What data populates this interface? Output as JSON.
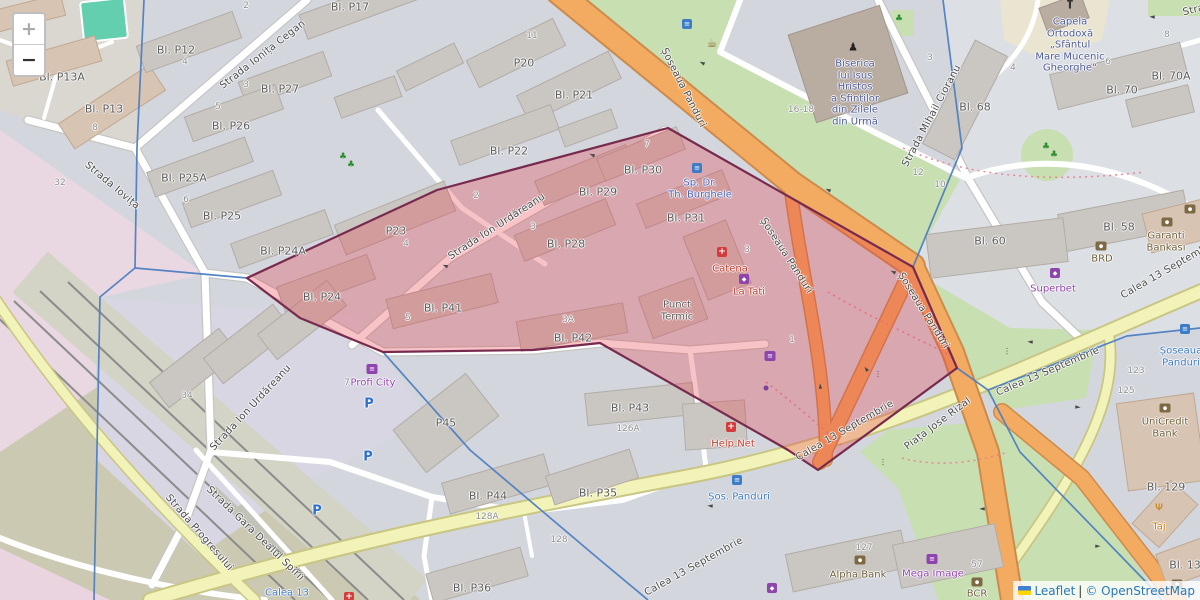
{
  "colors": {
    "hl_fill": "rgba(229,57,70,0.30)",
    "hl_stroke": "#772a4e",
    "boundary": "#4e7ec1",
    "link": "#2a77b8"
  },
  "controls": {
    "zoom_in": "+",
    "zoom_out": "−"
  },
  "attribution": {
    "leaflet": "Leaflet",
    "separator": "|",
    "osm": "© OpenStreetMap"
  },
  "icon_glyphs": {
    "bus": "≡",
    "cafe": "☕",
    "pharmacy": "+",
    "bank": "●",
    "cart": "≡",
    "shop": "◆",
    "betting": "◆",
    "restaurant": "Ψ",
    "church": "†",
    "statue": "♟",
    "parking": "P",
    "tree": "♣",
    "signal": "⋮",
    "arrow": "►",
    "dot-purple": ""
  },
  "map": {
    "street_labels": [
      {
        "t": "Strada Ionița Cegan",
        "x": 263,
        "y": 55,
        "r": -38
      },
      {
        "t": "Strada Iovița",
        "x": 112,
        "y": 186,
        "r": 40
      },
      {
        "t": "Strada Ion Urdăreanu",
        "x": 497,
        "y": 227,
        "r": -33
      },
      {
        "t": "Strada Ion Urdăreanu",
        "x": 251,
        "y": 408,
        "r": -47
      },
      {
        "t": "Șoseaua Panduri",
        "x": 683,
        "y": 88,
        "r": 63
      },
      {
        "t": "Șoseaua Panduri",
        "x": 786,
        "y": 256,
        "r": 57
      },
      {
        "t": "Șoseaua Panduri",
        "x": 923,
        "y": 311,
        "r": 58
      },
      {
        "t": "Calea 13 Septembrie",
        "x": 845,
        "y": 431,
        "r": -30
      },
      {
        "t": "Piața Jose Rizal",
        "x": 938,
        "y": 424,
        "r": -37
      },
      {
        "t": "Calea 13 Septembrie",
        "x": 1048,
        "y": 372,
        "r": -23
      },
      {
        "t": "Calea 13 Septembrie",
        "x": 1170,
        "y": 269,
        "r": -30
      },
      {
        "t": "Calea 13 Septembrie",
        "x": 694,
        "y": 567,
        "r": -29
      },
      {
        "t": "Strada Progresului",
        "x": 199,
        "y": 533,
        "r": 49
      },
      {
        "t": "Strada Gara Dealul Spirii",
        "x": 255,
        "y": 534,
        "r": 44
      },
      {
        "t": "Strada Mihail Cioranu",
        "x": 932,
        "y": 116,
        "r": -62
      },
      {
        "t": "Strada",
        "x": 1200,
        "y": 9,
        "r": -14
      }
    ],
    "building_labels": [
      {
        "t": "Bl. P13A",
        "x": 62,
        "y": 78
      },
      {
        "t": "Bl. P13",
        "x": 104,
        "y": 110
      },
      {
        "t": "Bl. P12",
        "x": 176,
        "y": 51
      },
      {
        "t": "Bl. P27",
        "x": 280,
        "y": 90
      },
      {
        "t": "Bl. P26",
        "x": 231,
        "y": 127
      },
      {
        "t": "Bl. P17",
        "x": 350,
        "y": 8
      },
      {
        "t": "P20",
        "x": 524,
        "y": 64
      },
      {
        "t": "Bl. P21",
        "x": 574,
        "y": 96
      },
      {
        "t": "Bl. P25A",
        "x": 184,
        "y": 179
      },
      {
        "t": "Bl. P25",
        "x": 222,
        "y": 217
      },
      {
        "t": "Bl. P24A",
        "x": 283,
        "y": 252
      },
      {
        "t": "Bl. P24",
        "x": 322,
        "y": 298
      },
      {
        "t": "Bl. P22",
        "x": 509,
        "y": 152
      },
      {
        "t": "P23",
        "x": 396,
        "y": 232
      },
      {
        "t": "Bl. P29",
        "x": 598,
        "y": 193
      },
      {
        "t": "Bl. P30",
        "x": 643,
        "y": 171
      },
      {
        "t": "Bl. P28",
        "x": 566,
        "y": 245
      },
      {
        "t": "Bl. P31",
        "x": 686,
        "y": 219
      },
      {
        "t": "Bl. P41",
        "x": 443,
        "y": 309
      },
      {
        "t": "Bl. P42",
        "x": 573,
        "y": 339
      },
      {
        "t": "Bl. P43",
        "x": 630,
        "y": 409
      },
      {
        "t": "P45",
        "x": 446,
        "y": 424
      },
      {
        "t": "Bl. P44",
        "x": 488,
        "y": 497
      },
      {
        "t": "Bl. P36",
        "x": 472,
        "y": 589
      },
      {
        "t": "Bl. P35",
        "x": 598,
        "y": 494
      },
      {
        "t": "Bl. 68",
        "x": 975,
        "y": 108
      },
      {
        "t": "Bl. 70",
        "x": 1122,
        "y": 91
      },
      {
        "t": "Bl. 70A",
        "x": 1171,
        "y": 77
      },
      {
        "t": "Bl. 58",
        "x": 1119,
        "y": 228
      },
      {
        "t": "Bl. 60",
        "x": 990,
        "y": 242
      },
      {
        "t": "Bl. 129",
        "x": 1166,
        "y": 488
      },
      {
        "t": "Bl. 13",
        "x": 1185,
        "y": 566
      }
    ],
    "house_numbers": [
      {
        "t": "2",
        "x": 246,
        "y": 6
      },
      {
        "t": "4",
        "x": 185,
        "y": 62
      },
      {
        "t": "3",
        "x": 246,
        "y": 85
      },
      {
        "t": "5",
        "x": 218,
        "y": 107
      },
      {
        "t": "8",
        "x": 95,
        "y": 128
      },
      {
        "t": "32",
        "x": 60,
        "y": 183
      },
      {
        "t": "6",
        "x": 186,
        "y": 200
      },
      {
        "t": "34",
        "x": 187,
        "y": 396
      },
      {
        "t": "11",
        "x": 532,
        "y": 36
      },
      {
        "t": "7",
        "x": 647,
        "y": 145
      },
      {
        "t": "2",
        "x": 476,
        "y": 196
      },
      {
        "t": "3",
        "x": 533,
        "y": 227
      },
      {
        "t": "4",
        "x": 406,
        "y": 244
      },
      {
        "t": "16-18",
        "x": 801,
        "y": 110
      },
      {
        "t": "3",
        "x": 930,
        "y": 58
      },
      {
        "t": "4",
        "x": 1013,
        "y": 68
      },
      {
        "t": "6",
        "x": 1108,
        "y": 62
      },
      {
        "t": "8",
        "x": 1167,
        "y": 35
      },
      {
        "t": "12",
        "x": 918,
        "y": 173
      },
      {
        "t": "10",
        "x": 940,
        "y": 185
      },
      {
        "t": "3",
        "x": 747,
        "y": 250
      },
      {
        "t": "1",
        "x": 792,
        "y": 340
      },
      {
        "t": "5",
        "x": 408,
        "y": 318
      },
      {
        "t": "3A",
        "x": 568,
        "y": 320
      },
      {
        "t": "7",
        "x": 347,
        "y": 383
      },
      {
        "t": "126A",
        "x": 628,
        "y": 429
      },
      {
        "t": "128A",
        "x": 487,
        "y": 517
      },
      {
        "t": "128",
        "x": 559,
        "y": 540
      },
      {
        "t": "123",
        "x": 1136,
        "y": 371
      },
      {
        "t": "125",
        "x": 1126,
        "y": 391
      },
      {
        "t": "127",
        "x": 864,
        "y": 548
      },
      {
        "t": "57",
        "x": 977,
        "y": 565
      }
    ],
    "pois": [
      {
        "t": "Catena",
        "x": 730,
        "y": 269,
        "c": "red"
      },
      {
        "t": "La Tati",
        "x": 749,
        "y": 292,
        "c": "red"
      },
      {
        "t": "Profi City",
        "x": 373,
        "y": 383,
        "c": "purple"
      },
      {
        "t": "Help Net",
        "x": 733,
        "y": 444,
        "c": "red"
      },
      {
        "t": "Superbet",
        "x": 1053,
        "y": 289,
        "c": "purple"
      },
      {
        "t": "BRD",
        "x": 1102,
        "y": 259,
        "c": "bank"
      },
      {
        "t": "Mega Image",
        "x": 933,
        "y": 574,
        "c": "purple"
      },
      {
        "t": "BCR",
        "x": 977,
        "y": 594,
        "c": "bank"
      },
      {
        "t": "Alpha Bank",
        "x": 858,
        "y": 575,
        "c": "bank"
      },
      {
        "t": "Taj",
        "x": 1159,
        "y": 527,
        "c": "orange"
      },
      {
        "t": "Șos. Panduri",
        "x": 739,
        "y": 497,
        "c": "transit"
      },
      {
        "t": "Calea 13",
        "x": 287,
        "y": 593,
        "c": "transit"
      }
    ],
    "multi_labels": [
      {
        "lines": [
          "Punct",
          "Termic"
        ],
        "x": 677,
        "y": 311,
        "c": "bnamec"
      },
      {
        "lines": [
          "Sp. Dr.",
          "Th. Burghele"
        ],
        "x": 700,
        "y": 189,
        "c": "hospital"
      },
      {
        "lines": [
          "Biserica",
          "lui Isus",
          "Hristos",
          "a Sfinților",
          "din Zilele",
          "din Urmă"
        ],
        "x": 855,
        "y": 93,
        "c": "religious"
      },
      {
        "lines": [
          "Capela",
          "Ortodoxă",
          "„Sfântul",
          "Mare Mucenic",
          "Gheorghe“"
        ],
        "x": 1070,
        "y": 45,
        "c": "religious"
      },
      {
        "lines": [
          "Garanti",
          "Bankası"
        ],
        "x": 1166,
        "y": 242,
        "c": "bank"
      },
      {
        "lines": [
          "UniCredit",
          "Bank"
        ],
        "x": 1165,
        "y": 428,
        "c": "bank"
      },
      {
        "lines": [
          "Șoseaua",
          "Panduri"
        ],
        "x": 1181,
        "y": 357,
        "c": "transit"
      }
    ],
    "icons": [
      {
        "k": "bus",
        "x": 687,
        "y": 24
      },
      {
        "k": "bus",
        "x": 697,
        "y": 168
      },
      {
        "k": "bus",
        "x": 737,
        "y": 480
      },
      {
        "k": "bus",
        "x": 1185,
        "y": 329
      },
      {
        "k": "cafe",
        "x": 712,
        "y": 43
      },
      {
        "k": "pharmacy",
        "x": 722,
        "y": 252
      },
      {
        "k": "pharmacy",
        "x": 731,
        "y": 427
      },
      {
        "k": "pharmacy",
        "x": 349,
        "y": 597
      },
      {
        "k": "shop",
        "x": 744,
        "y": 279
      },
      {
        "k": "shop",
        "x": 772,
        "y": 588
      },
      {
        "k": "cart",
        "x": 372,
        "y": 369
      },
      {
        "k": "cart",
        "x": 770,
        "y": 356
      },
      {
        "k": "cart",
        "x": 932,
        "y": 559
      },
      {
        "k": "dot-purple",
        "x": 766,
        "y": 388
      },
      {
        "k": "betting",
        "x": 1055,
        "y": 273
      },
      {
        "k": "bank",
        "x": 1101,
        "y": 246
      },
      {
        "k": "bank",
        "x": 1167,
        "y": 222
      },
      {
        "k": "bank",
        "x": 1190,
        "y": 209
      },
      {
        "k": "bank",
        "x": 1165,
        "y": 408
      },
      {
        "k": "bank",
        "x": 860,
        "y": 560
      },
      {
        "k": "bank",
        "x": 977,
        "y": 582
      },
      {
        "k": "bank",
        "x": 1177,
        "y": 584
      },
      {
        "k": "restaurant",
        "x": 1159,
        "y": 508
      },
      {
        "k": "church",
        "x": 1070,
        "y": 4
      },
      {
        "k": "statue",
        "x": 853,
        "y": 47
      },
      {
        "k": "parking",
        "x": 369,
        "y": 404
      },
      {
        "k": "parking",
        "x": 368,
        "y": 457
      },
      {
        "k": "parking",
        "x": 317,
        "y": 511
      },
      {
        "k": "tree",
        "x": 343,
        "y": 157
      },
      {
        "k": "tree",
        "x": 351,
        "y": 165
      },
      {
        "k": "tree",
        "x": 1046,
        "y": 147
      },
      {
        "k": "tree",
        "x": 1054,
        "y": 155
      },
      {
        "k": "tree",
        "x": 899,
        "y": 19
      },
      {
        "k": "signal",
        "x": 883,
        "y": 462
      },
      {
        "k": "signal",
        "x": 1007,
        "y": 351
      },
      {
        "k": "signal",
        "x": 878,
        "y": 374
      },
      {
        "k": "signal",
        "x": 1022,
        "y": 588
      },
      {
        "k": "arrow",
        "x": 702,
        "y": 63,
        "r": 205
      },
      {
        "k": "arrow",
        "x": 592,
        "y": 155,
        "r": 205
      },
      {
        "k": "arrow",
        "x": 828,
        "y": 190,
        "r": 205
      },
      {
        "k": "arrow",
        "x": 445,
        "y": 266,
        "r": 200
      },
      {
        "k": "arrow",
        "x": 866,
        "y": 369,
        "r": 235
      },
      {
        "k": "arrow",
        "x": 1030,
        "y": 342,
        "r": 185
      },
      {
        "k": "arrow",
        "x": 1078,
        "y": 407,
        "r": 5
      },
      {
        "k": "arrow",
        "x": 982,
        "y": 509,
        "r": 180
      },
      {
        "k": "arrow",
        "x": 1098,
        "y": 546,
        "r": 0
      },
      {
        "k": "arrow",
        "x": 710,
        "y": 506,
        "r": 185
      },
      {
        "k": "arrow",
        "x": 820,
        "y": 386,
        "r": 265
      },
      {
        "k": "arrow",
        "x": 893,
        "y": 272,
        "r": 205
      },
      {
        "k": "arrow",
        "x": 1152,
        "y": 17,
        "r": 185
      }
    ]
  }
}
